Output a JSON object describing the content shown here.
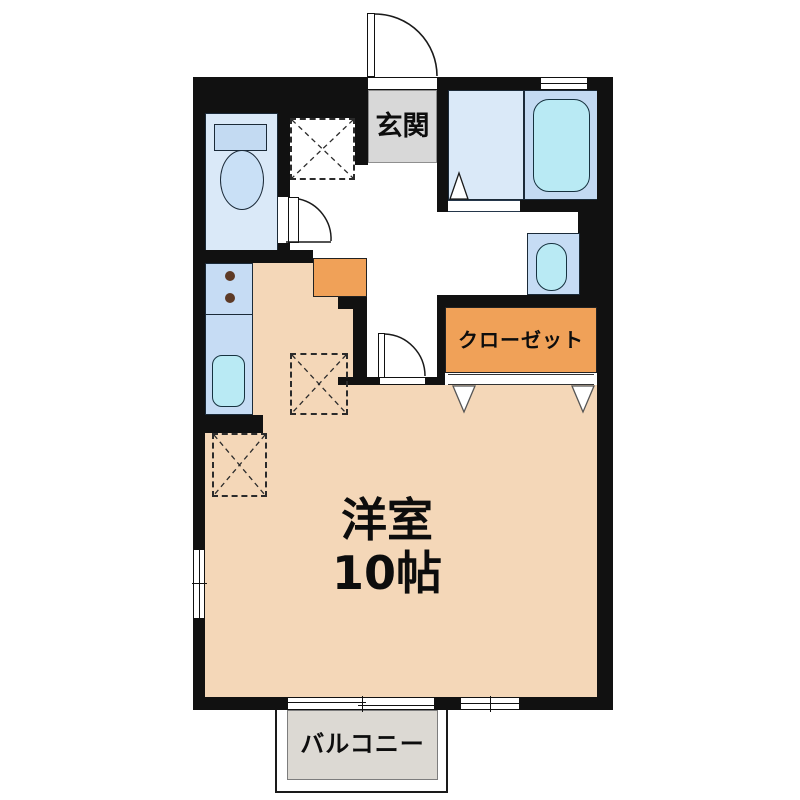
{
  "labels": {
    "entrance": "玄関",
    "closet": "クローゼット",
    "main_room_name": "洋室",
    "main_room_size": "10帖",
    "balcony": "バルコニー"
  },
  "colors": {
    "wall": "#111111",
    "room-peach": "#f4d7b8",
    "accent-orange": "#f0a158",
    "floor-blue": "#dae9f8",
    "fixture-blue": "#c3daf2",
    "counter-blue": "#c6dcf4",
    "water-cyan": "#b9eaf4",
    "bowl-blue": "#c9e0f6",
    "entrance-gray": "#d8d8d8",
    "balcony-gray": "#dcd9d3"
  }
}
